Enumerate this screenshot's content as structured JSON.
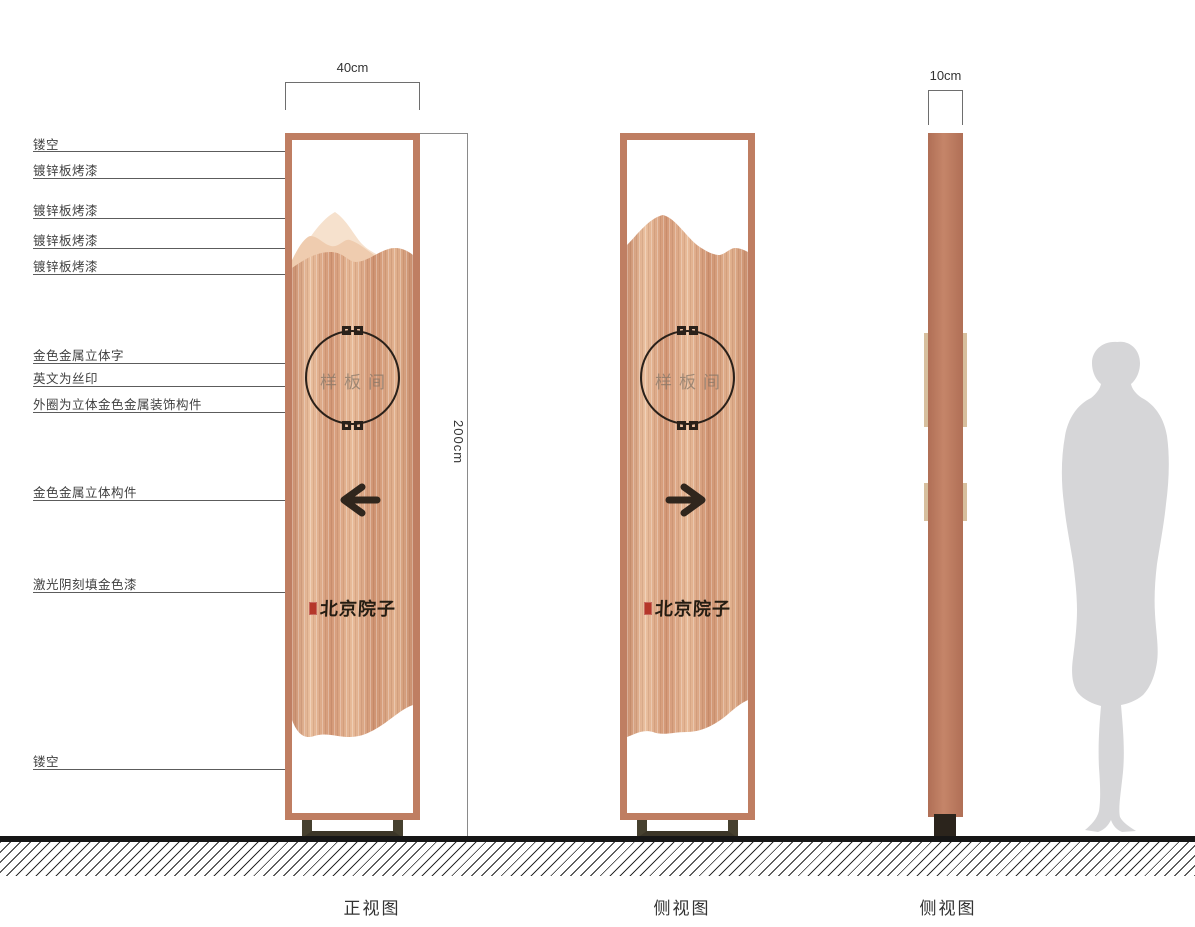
{
  "callouts": [
    "镂空",
    "镀锌板烤漆",
    "镀锌板烤漆",
    "镀锌板烤漆",
    "镀锌板烤漆",
    "金色金属立体字",
    "英文为丝印",
    "外圈为立体金色金属装饰构件",
    "金色金属立体构件",
    "激光阴刻填金色漆",
    "镂空"
  ],
  "dimensions": {
    "front_width": "40cm",
    "side_width": "10cm",
    "height": "200cm"
  },
  "view_labels": [
    "正视图",
    "侧视图",
    "侧视图"
  ],
  "sign": {
    "zone_name": "样板间",
    "brand_name": "北京院子"
  },
  "colors": {
    "frame_copper": "#bf7e62",
    "wood_base": "#d99f7f",
    "mountain_light": "#f6e1cd",
    "mountain_mid": "#efccaf",
    "ink_dark": "#2a211a",
    "seal_red": "#b5372a",
    "base_olive": "#46402f",
    "silhouette_gray": "#d6d6d8"
  }
}
